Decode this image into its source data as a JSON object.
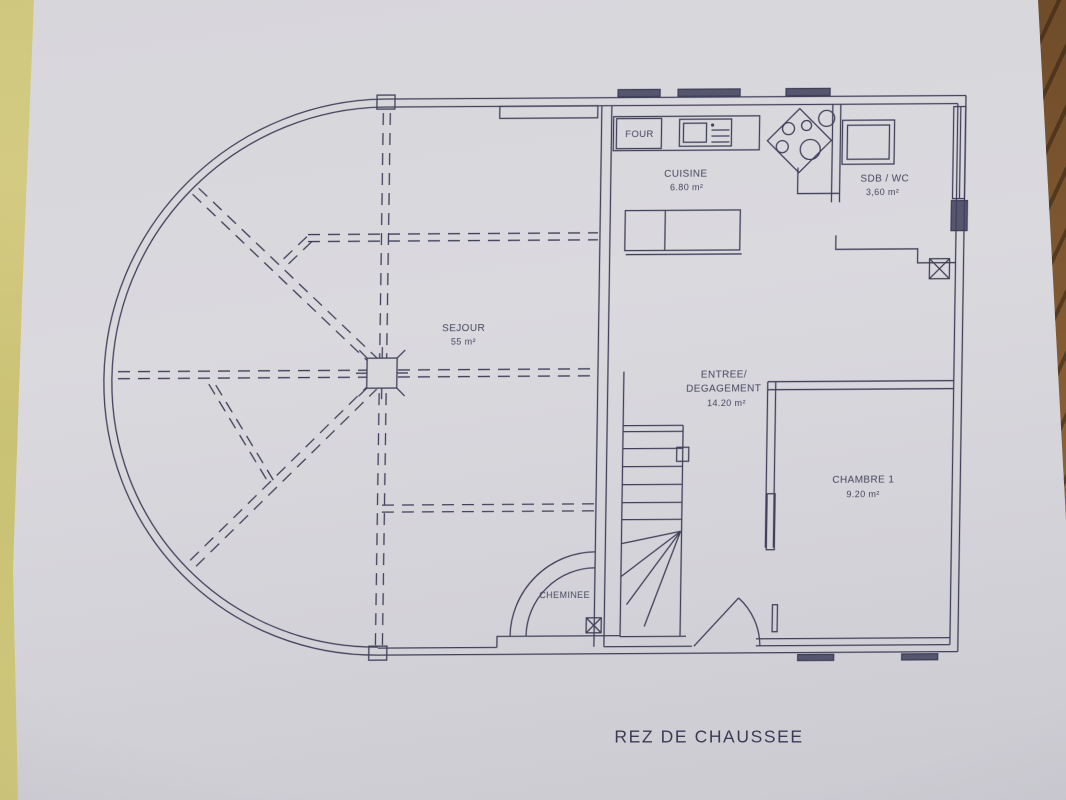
{
  "plan": {
    "title": "REZ DE CHAUSSEE",
    "rooms": [
      {
        "name": "SEJOUR",
        "area": "55 m²"
      },
      {
        "name": "CUISINE",
        "area": "6.80 m²"
      },
      {
        "name": "SDB / WC",
        "area": "3,60 m²"
      },
      {
        "name_line1": "ENTREE/",
        "name_line2": "DEGAGEMENT",
        "area": "14.20 m²"
      },
      {
        "name": "CHAMBRE 1",
        "area": "9.20 m²"
      }
    ],
    "annotations": [
      {
        "label": "FOUR"
      },
      {
        "label": "CHEMINEE"
      }
    ],
    "colors": {
      "paper": "#d8d7dc",
      "ink": "#40405a",
      "table_left": "#cfc77b",
      "table_right": "#8a6137"
    }
  }
}
